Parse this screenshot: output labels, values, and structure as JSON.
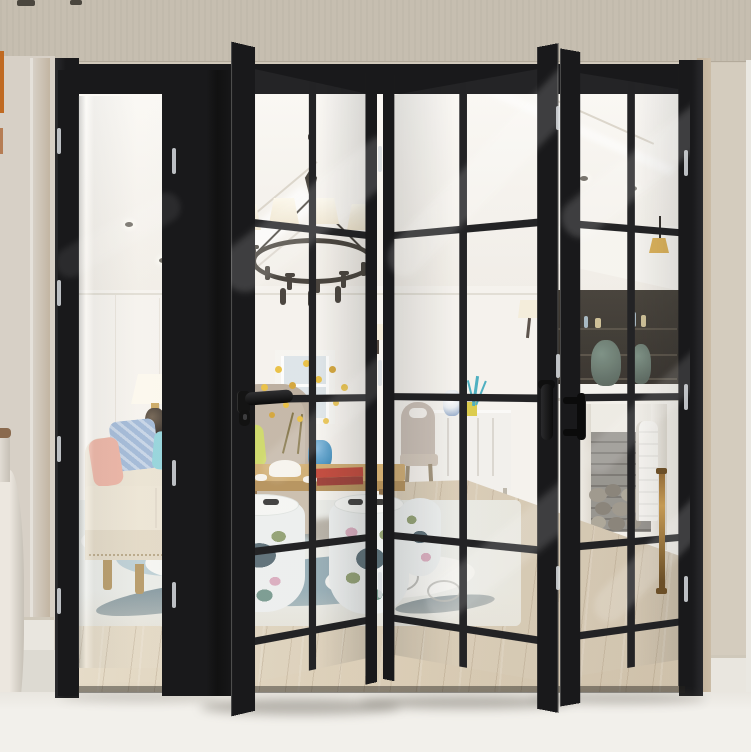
{
  "meta": {
    "image_type": "product-photo",
    "subject": "matte black aluminium bi-fold glass patio door, partially folded open, revealing a bright modern living room"
  },
  "door": {
    "finish": "matte black aluminium",
    "panel_count": 4,
    "panels": [
      {
        "id": "panel-1",
        "state": "flat in opening",
        "glazing": "single clear full lite",
        "hardware": []
      },
      {
        "id": "panel-2",
        "state": "folded outward, left edge toward viewer",
        "glazing": "2x5 grille lites",
        "hardware": [
          "black lever handle",
          "keyhole escutcheon"
        ]
      },
      {
        "id": "panel-3",
        "state": "folded outward, right edge toward viewer",
        "glazing": "2x5 grille lites",
        "hardware": [
          "black edge handle"
        ]
      },
      {
        "id": "panel-4",
        "state": "angled back to right jamb",
        "glazing": "2x5 grille lites",
        "hardware": [
          "black D-pull",
          "brass rod handle"
        ]
      }
    ],
    "hinges": "bright metal hinge pins on jambs and fold lines"
  },
  "interior": {
    "items": [
      "ring chandelier with white shades",
      "recessed ceiling cove with downlights",
      "decorative wall plates",
      "table lamp",
      "cream fabric sofa with blue, teal and pink pillows",
      "beige wingback armchair with lime pillow",
      "wood coffee table with red books, tea set, blue vase and yellow flowers",
      "ceramic garden stools with floral pattern",
      "abstract blue-grey area rug",
      "light oak wood floor",
      "white sideboard with blue-white jar, yellow box and teal coral",
      "upholstered dining chair",
      "white fireplace mantel with patina urns, brick firebox and stacked stones",
      "dark display cabinet with bottles and brass pendant lamp",
      "wall sconces"
    ]
  },
  "background": {
    "walls": "warm greige painted walls",
    "left_edge": [
      "orange accent sliver",
      "tall white floor vase",
      "white baseboard"
    ],
    "right_edge": [
      "tan door trim",
      "white pilaster",
      "white baseboard"
    ],
    "floor": "bright off-white foreground floor with soft door shadows"
  },
  "palette": {
    "ink": "#19191b",
    "ink2": "#2a2a2d",
    "hinge": "#d9dde0",
    "wallTop": "#c6beb0",
    "wall": "#d0c8ba",
    "wallR": "#d4ccbe",
    "line": "#b3aa9b",
    "lwall": "#d7d0c6",
    "ltrim": "#c2b5a2",
    "lwhite": "#e5e1da",
    "rtrim": "#bfae96",
    "pilaster": "#eae8e2",
    "board": "#e9e6df",
    "boardLine": "#cfc8ba",
    "floorFg": "#f2f0eb",
    "floorL": "#dddad2",
    "orange": "#c06a22",
    "orange2": "#a85a24",
    "vasew": "#ece7df",
    "vasewD": "#c6c0b6",
    "vasewRim": "#8a6a4e",
    "room": "#f4f1ea",
    "ceilHi": "#fbf9f5",
    "ceilLn": "#d9d3c8",
    "inwall": "#f6f3ee",
    "seam": "#e8e3da",
    "p1": "#7088b2",
    "p2": "#8aa668",
    "p3": "#44588a",
    "p4": "#9db87a",
    "p5": "#5c74a0",
    "lampS": "#fdf9ee",
    "lampB": "#2e2620",
    "gold": "#c9a45a",
    "sofa": "#eae2d1",
    "sofaF": "#e2d8c4",
    "nail": "#b5a381",
    "pBlue": "#9db6d6",
    "pTeal": "#8ed2da",
    "pPink": "#ecb0a0",
    "lime": "#ccd75f",
    "wood": "#b2945f",
    "chair": "#b7a898",
    "chairL": "#c8baa9",
    "plantG": "#5b7a49",
    "potG": "#8a8a82",
    "met": "#37322b",
    "ttop": "#cfa96a",
    "tedge": "#b08a50",
    "tleg": "#8a6a42",
    "red": "#bf3a2c",
    "red2": "#963028",
    "white": "#f7f4ed",
    "vblue": "#3f8fc0",
    "fy": "#e9bd36",
    "fy2": "#d2a02c",
    "stem": "#7a6a3a",
    "stool": "#edf0f0",
    "stoolTop": "#f6f7f5",
    "slot": "#2e2e2e",
    "stTeal": "#6f9488",
    "stOlive": "#8a9a6a",
    "stPink": "#d8a8bc",
    "rug": "#e9ebe7",
    "rA": "#b9cdd4",
    "rB": "#8fa8b2",
    "rC": "#667f8b",
    "rW": "#f6f6f3",
    "rD": "#4f646e",
    "rSwirl": "#a8a8a2",
    "fl1": "#e6dcc8",
    "fl2": "#cbbda6",
    "plank": "rgba(125,100,70,0.20)",
    "sb": "#f3f1ed",
    "sbLn": "#d8d4ce",
    "jar": "#e8edf2",
    "jarB": "#4a6fa8",
    "ybox": "#d9c93a",
    "coral": "#3aa8bc",
    "dch": "#c6bab0",
    "dchL": "#9a8a70",
    "soffit": "#f7f5f0",
    "cab": "#2c2822",
    "cabLn": "#4a4338",
    "bo1": "#cabb8e",
    "bo2": "#9fb2bd",
    "pend": "#d9ab4a",
    "mant": "#f5f3ee",
    "mantSh": "#cfc9bd",
    "urn": "#71877a",
    "urnD": "#4f5e55",
    "brick": "#8d8a85",
    "brickJ": "#6f6c67",
    "st1": "#968f83",
    "st2": "#7e786d",
    "st3": "#a59e90",
    "lean": "#f7f5f1",
    "scS": "#f5edd9",
    "scA": "#4a4038",
    "brass": "#c49a54",
    "brassD": "#6b4f28",
    "shadow": "rgba(95,89,79,0.40)",
    "thresh": "rgba(38,35,30,0.45)",
    "streakW": "rgba(255,255,255,0.16)"
  }
}
